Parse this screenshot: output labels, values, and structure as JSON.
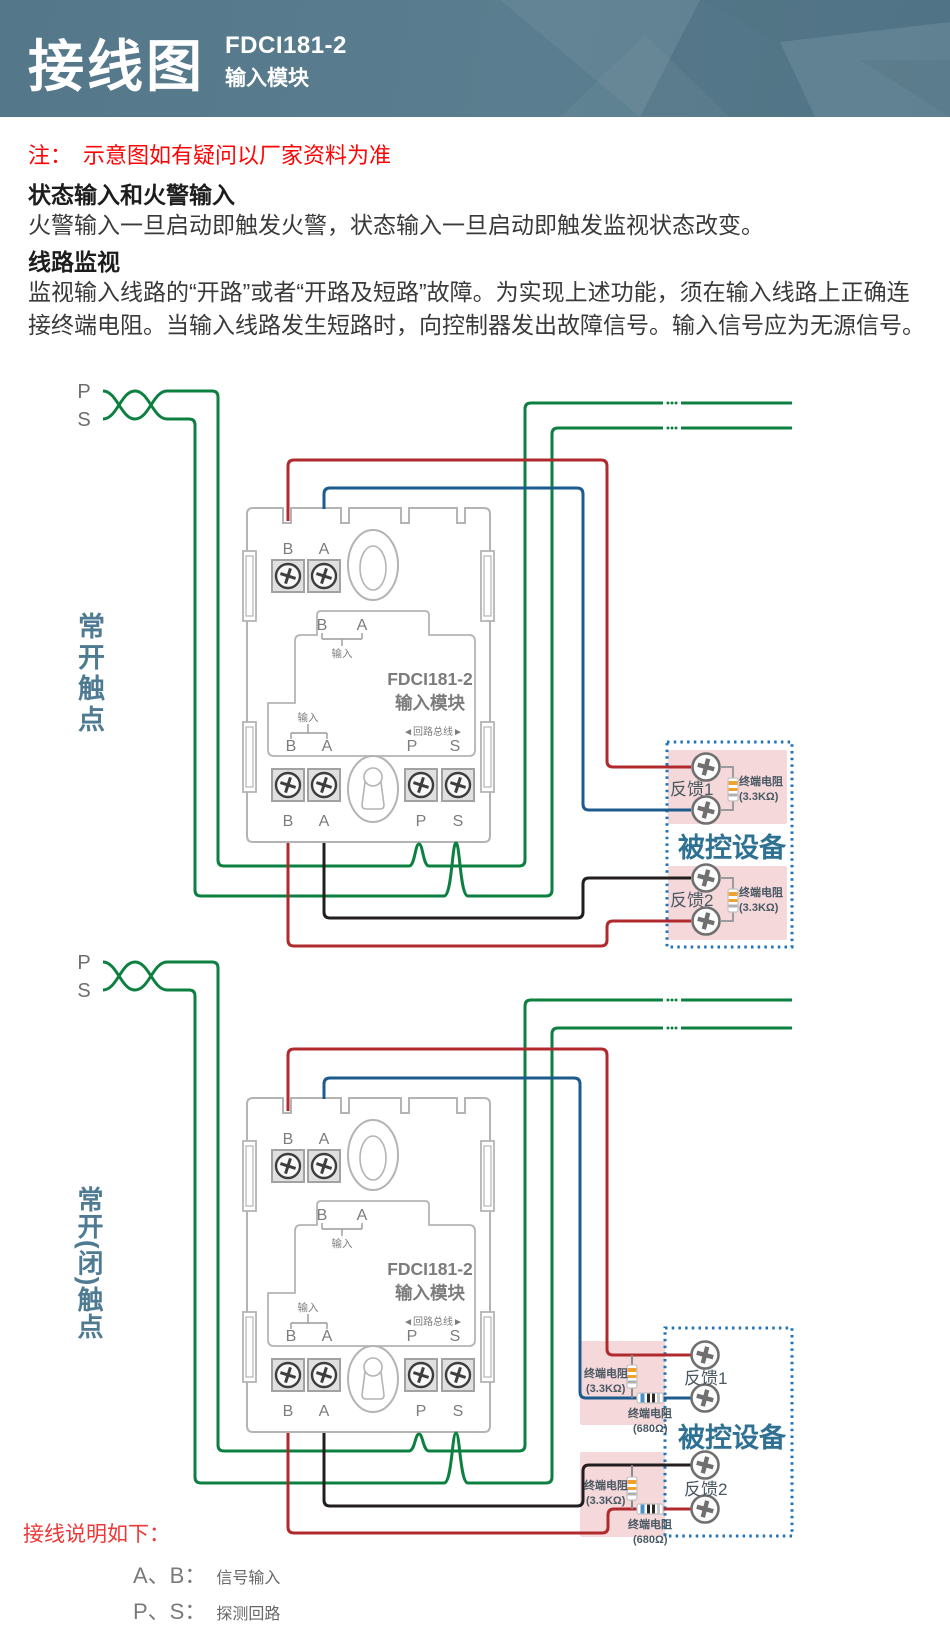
{
  "header": {
    "title": "接线图",
    "model": "FDCI181-2",
    "subtitle": "输入模块"
  },
  "intro": {
    "note": "注：　示意图如有疑问以厂家资料为准",
    "heading1": "状态输入和火警输入",
    "para1": "火警输入一旦启动即触发火警，状态输入一旦启动即触发监视状态改变。",
    "heading2": "线路监视",
    "para2": "监视输入线路的“开路”或者“开路及短路”故障。为实现上述功能，须在输入线路上正确连接终端电阻。当输入线路发生短路时，向控制器发出故障信号。输入信号应为无源信号。"
  },
  "loop": {
    "p": "P",
    "s": "S"
  },
  "module": {
    "b": "B",
    "a": "A",
    "p": "P",
    "s": "S",
    "input": "输入",
    "bus": "◄回路总线►",
    "model": "FDCI181-2",
    "type": "输入模块"
  },
  "d1": {
    "side": "常开触点",
    "fb1": "反馈1",
    "fb2": "反馈2",
    "device": "被控设备",
    "res_label": "终端电阻",
    "res_33": "(3.3KΩ)"
  },
  "d2": {
    "side": "常开(闭)触点",
    "fb1": "反馈1",
    "fb2": "反馈2",
    "device": "被控设备",
    "res_label": "终端电阻",
    "res_33": "(3.3KΩ)",
    "res_680": "(680Ω)"
  },
  "legend": {
    "title": "接线说明如下：",
    "rows": [
      {
        "term": "A、B：",
        "desc": "信号输入"
      },
      {
        "term": "P、S：",
        "desc": "探测回路"
      }
    ]
  },
  "colors": {
    "loop_wire": "#0c8040",
    "b_wire": "#b02a2d",
    "a_wire": "#1e5b8d",
    "black_wire": "#221e1f",
    "dotted_box": "#2273b8",
    "pink_box": "#f4d8da",
    "side_label": "#4e7b92",
    "note_red": "#fe0505",
    "header_bg": "#54778a"
  }
}
